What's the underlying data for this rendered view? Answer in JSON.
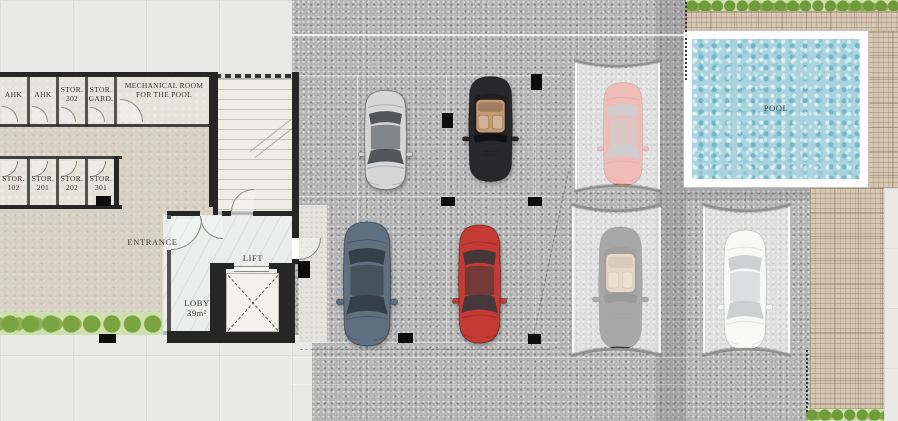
{
  "plan": {
    "rooms_top": [
      {
        "label": "AHK",
        "number": ""
      },
      {
        "label": "AHK",
        "number": ""
      },
      {
        "label": "STOR.",
        "number": "302"
      },
      {
        "label": "STOR.",
        "number": "GARD."
      }
    ],
    "mechanical_room": "MECHANICAL ROOM FOR THE POOL",
    "rooms_bottom": [
      {
        "label": "STOR.",
        "number": "102"
      },
      {
        "label": "STOR.",
        "number": "201"
      },
      {
        "label": "STOR.",
        "number": "202"
      },
      {
        "label": "STOR.",
        "number": "301"
      }
    ],
    "entrance": "ENTRANCE",
    "lift": "LIFT",
    "lobby": {
      "name": "LOBY",
      "area": "39m²"
    },
    "pool": "POOL"
  },
  "cars": [
    {
      "name": "silver sedan",
      "type": "sedan",
      "color": "#d6d6d6",
      "glass": "#3f4549",
      "covered": false
    },
    {
      "name": "black convertible",
      "type": "convertible",
      "color": "#28282a",
      "interior": "#c49a72",
      "covered": false
    },
    {
      "name": "slate blue sedan",
      "type": "sedan",
      "color": "#5f7181",
      "glass": "#2f3a42",
      "covered": false
    },
    {
      "name": "red sedan",
      "type": "sedan",
      "color": "#c53a33",
      "glass": "#33383c",
      "covered": false
    },
    {
      "name": "red sedan under canopy",
      "type": "sedan",
      "color": "#e0625a",
      "glass": "#8a8f93",
      "covered": true
    },
    {
      "name": "black convertible under canopy",
      "type": "convertible",
      "color": "#333335",
      "interior": "#c9a37b",
      "covered": true
    },
    {
      "name": "white sedan under canopy",
      "type": "sedan",
      "color": "#f0f0ef",
      "glass": "#7c8286",
      "covered": true
    }
  ],
  "colors": {
    "concrete": "#b6b6b6",
    "building_floor": "#d8d0c3",
    "paving_tile": "#e9e9e7",
    "pool_water": "#a9d4df",
    "wood_deck": "#d5c7b4",
    "hedge_green": "#7aa341",
    "wall": "#262626"
  }
}
